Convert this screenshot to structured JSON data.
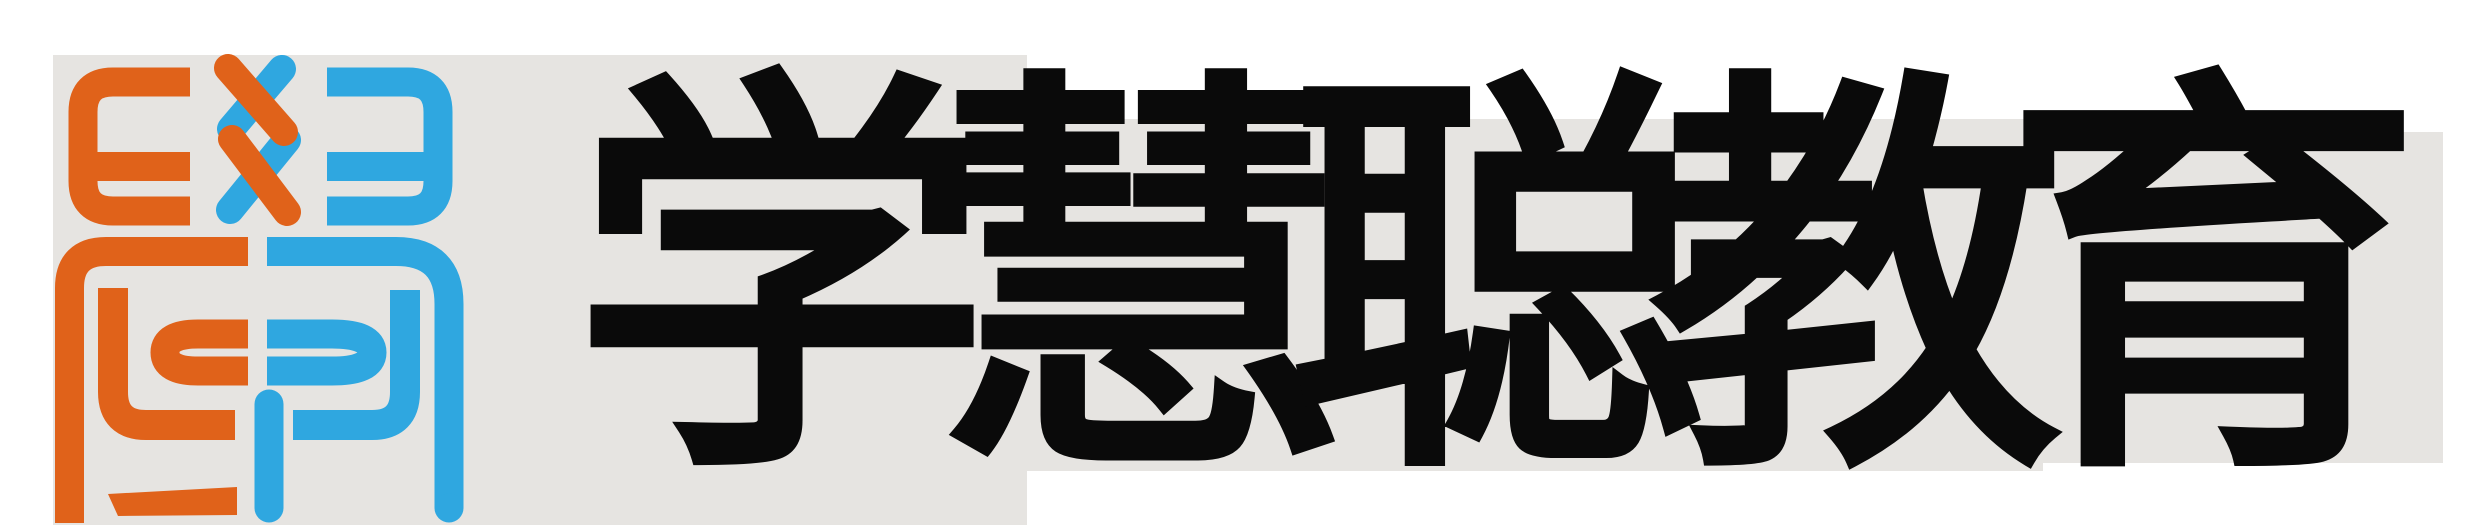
{
  "brand": {
    "name": "学慧聪教育",
    "characters": [
      "学",
      "慧",
      "聪",
      "教",
      "育"
    ]
  },
  "logo": {
    "mark_description": "Stylized 學 monogram: orange E and blue mirrored Ǝ flanking an interlaced double-X (爻) strand, above a two-tone rounded enclosure with nested C, P and hook strokes",
    "top_left_glyph": "E",
    "top_center_glyph": "爻",
    "top_right_glyph": "Ǝ"
  },
  "colors": {
    "orange": "#E0621A",
    "blue": "#2FA7E0",
    "panel_gray": "#E6E4E1",
    "text_black": "#0A0A0A",
    "page_background": "#FFFFFF"
  }
}
